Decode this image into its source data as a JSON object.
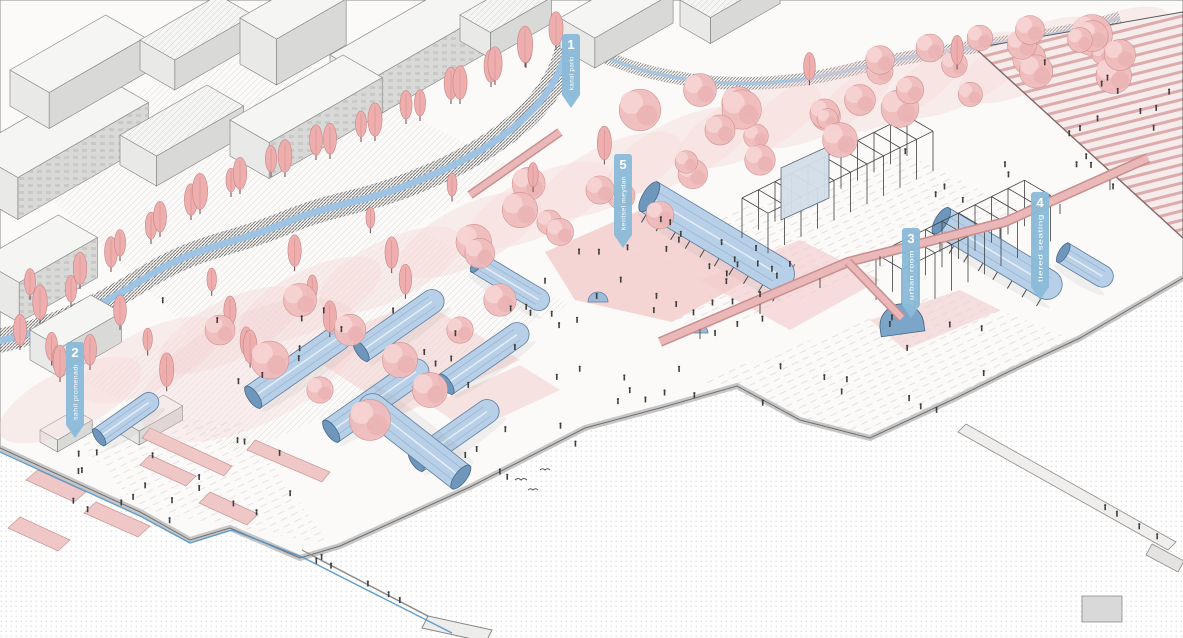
{
  "illustration": {
    "title": "waterfront masterplan axonometric rendering",
    "markers": [
      {
        "number": "1",
        "label": "kanal parkı",
        "x": 571,
        "y": 34,
        "h": 58
      },
      {
        "number": "2",
        "label": "sahil promenadı",
        "x": 75,
        "y": 342,
        "h": 80
      },
      {
        "number": "3",
        "label": "urban room",
        "x": 911,
        "y": 228,
        "h": 74
      },
      {
        "number": "4",
        "label": "tiered seating",
        "x": 1040,
        "y": 192,
        "h": 92
      },
      {
        "number": "5",
        "label": "kentsel meydan",
        "x": 623,
        "y": 154,
        "h": 78
      }
    ],
    "palette": {
      "marker_blue": "#8abbd8",
      "tree_pink": "#f0bcbc",
      "plaza_pink": "#f4cfcf",
      "canopy_blue": "#b7cfe7",
      "canopy_blue_dark": "#6e97bb",
      "water_dot": "#d7d2cc",
      "building_gray": "#e7e7e6",
      "line_dark": "#3f3f3f",
      "path_blue": "#4f94c9"
    }
  }
}
